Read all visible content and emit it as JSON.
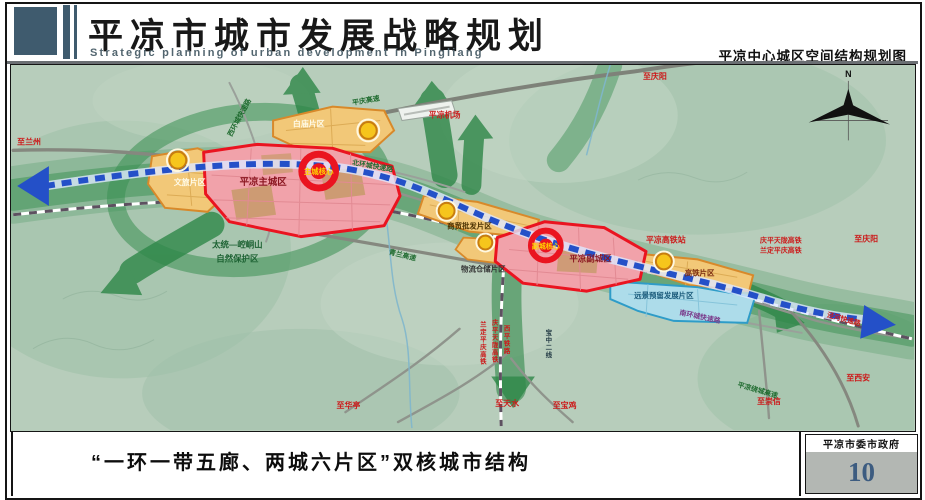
{
  "header": {
    "title": "平凉市城市发展战略规划",
    "subtitle": "Strategic planning of urban development in Pingliang",
    "map_sheet_title": "平凉中心城区空间结构规划图"
  },
  "footer": {
    "caption": "“一环一带五廊、两城六片区”双核城市结构",
    "organization": "平凉市委市政府",
    "page_number": "10"
  },
  "map": {
    "compass": "N",
    "zones": {
      "main_city": "平凉主城区",
      "sub_city": "平凉副城区",
      "baimiao": "白庙片区",
      "wenlv": "文旅片区",
      "shangmao": "商贸批发片区",
      "wuliu": "物流仓储片区",
      "gaotie": "高铁片区",
      "yuanjing": "远景预留发展片区"
    },
    "cores": {
      "main": "主城核心",
      "sub": "副城核心"
    },
    "places": {
      "airport": "平凉机场",
      "hsr_station": "平凉高铁站",
      "reserve_line1": "太统—崆峒山",
      "reserve_line2": "自然保护区"
    },
    "directions": {
      "lanzhou": "至兰州",
      "qingyang_top": "至庆阳",
      "qingyang_east": "至庆阳",
      "xian": "至西安",
      "chongxin": "至崇信",
      "huating": "至华亭",
      "tianshui": "至天水",
      "baoji": "至宝鸡"
    },
    "roads": {
      "west_ring": "西环城快速路",
      "north_ring": "北环城快速路",
      "south_ring": "南环城快速路",
      "pingqing_expressway": "平庆高速",
      "qinglan_expressway": "青兰高速",
      "ring_expressway": "平凉绕城高速",
      "jinghe_expressway": "泾河快速路"
    },
    "railways": {
      "qptl_hsr_ne": "庆平天陇高铁",
      "ldpq_hsr_ne": "兰定平庆高铁",
      "ldpq_hsr_s": "兰定平庆高铁",
      "qptl_hsr_s": "庆平天陇高铁",
      "xiping_railway": "西平铁路",
      "baozhong_line2": "宝中二线"
    },
    "colors": {
      "city_fill": "#F1A2AA",
      "city_border": "#EA1420",
      "district_fill": "#F2C878",
      "district_border": "#D8892A",
      "reserve_fill": "#ADDCEA",
      "reserve_border": "#2E9CC8",
      "eco_green": "#2E8748",
      "transit_blue": "#2450C8",
      "node_yellow": "#F6C51C",
      "terrain": "#B7CDBB"
    }
  }
}
